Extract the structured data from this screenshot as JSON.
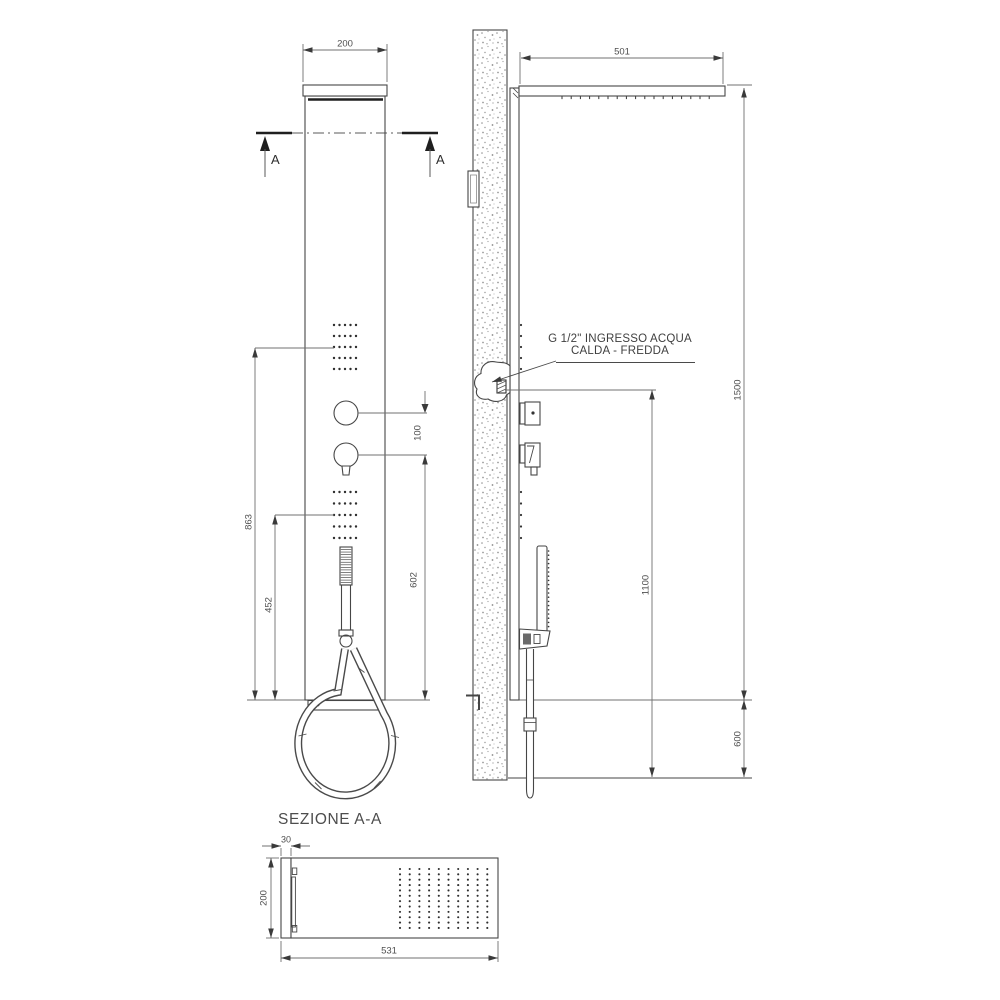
{
  "labels": {
    "section_title": "SEZIONE A-A",
    "section_marker": "A",
    "inlet_note_line1": "G 1/2\" INGRESSO ACQUA",
    "inlet_note_line2": "CALDA - FREDDA"
  },
  "dimensions": {
    "front_view": {
      "panel_width": "200",
      "upper_jets_center_height": "863",
      "handshower_center_height": "452",
      "knob_spacing": "100",
      "mixer_to_bottom": "602"
    },
    "side_view": {
      "shower_head_depth": "501",
      "panel_height": "1500",
      "water_inlet_height": "1100",
      "floor_clearance": "600"
    },
    "section_view": {
      "panel_thickness": "30",
      "panel_width": "200",
      "total_depth": "531"
    }
  },
  "colors": {
    "background": "#ffffff",
    "line": "#464646",
    "dim_line": "#707070",
    "text": "#4f4f4f",
    "accent_dark": "#1f1f1f",
    "wall_stipple": "#8f8f8f"
  }
}
